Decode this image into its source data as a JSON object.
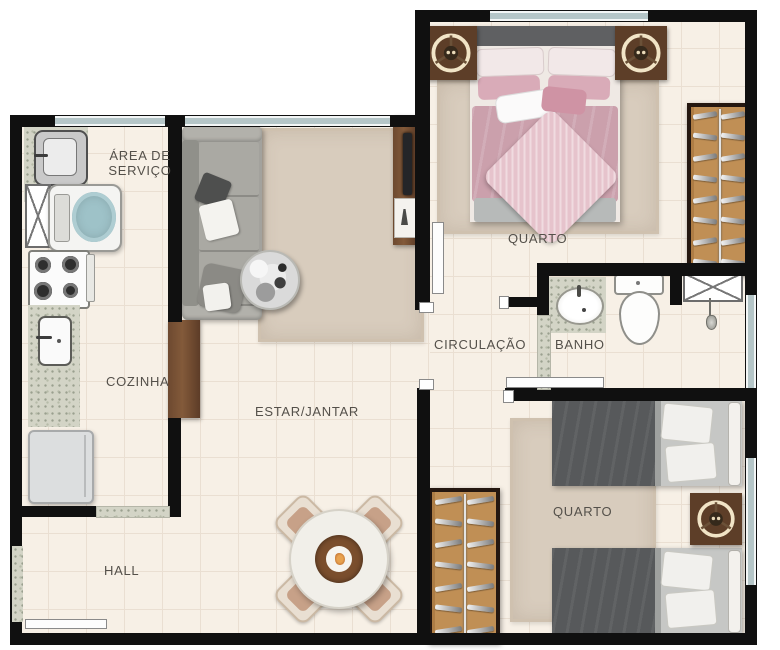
{
  "rooms": {
    "area_servico": {
      "line1": "ÁREA DE",
      "line2": "SERVIÇO"
    },
    "cozinha": {
      "label": "COZINHA"
    },
    "estar_jantar": {
      "label": "ESTAR/JANTAR"
    },
    "hall": {
      "label": "HALL"
    },
    "quarto1": {
      "label": "QUARTO"
    },
    "circulacao": {
      "label": "CIRCULAÇÃO"
    },
    "banho": {
      "label": "BANHO"
    },
    "quarto2": {
      "label": "QUARTO"
    }
  },
  "colors": {
    "wall": "#101010",
    "floor": "#f7f0e6",
    "window": "#b5c6c8",
    "wood": "#6d4930",
    "closet_interior": "#c08f55",
    "granite": "#d3d4c6",
    "rug": "#d8ccbd",
    "sofa_gray": "#a3a29d",
    "bed_pink": "#cba0ac",
    "bed_gray": "#57595b",
    "appliance_teal": "#9ec2c8",
    "label_text": "#54504a"
  }
}
